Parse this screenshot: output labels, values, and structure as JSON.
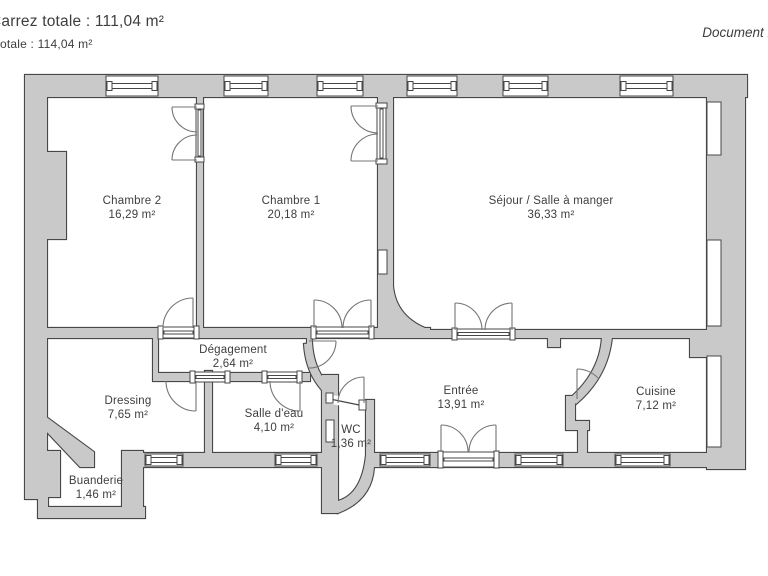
{
  "header": {
    "surface_line1": "Carrez totale : 111,04 m²",
    "surface_line2": "otale : 114,04 m²",
    "document_note": "Document n"
  },
  "colors": {
    "wall_fill": "#c9c9c9",
    "wall_outline": "#474747",
    "door_arc": "#757575",
    "text": "#3e3e3e",
    "background": "#ffffff"
  },
  "rooms": {
    "chambre2": {
      "name": "Chambre 2",
      "area": "16,29 m²"
    },
    "chambre1": {
      "name": "Chambre 1",
      "area": "20,18 m²"
    },
    "sejour": {
      "name": "Séjour / Salle à manger",
      "area": "36,33 m²"
    },
    "degagement": {
      "name": "Dégagement",
      "area": "2,64 m²"
    },
    "dressing": {
      "name": "Dressing",
      "area": "7,65 m²"
    },
    "salle_eau": {
      "name": "Salle d'eau",
      "area": "4,10 m²"
    },
    "wc": {
      "name": "WC",
      "area": "1,36 m²"
    },
    "entree": {
      "name": "Entrée",
      "area": "13,91 m²"
    },
    "cuisine": {
      "name": "Cuisine",
      "area": "7,12 m²"
    },
    "buanderie": {
      "name": "Buanderie",
      "area": "1,46 m²"
    }
  }
}
